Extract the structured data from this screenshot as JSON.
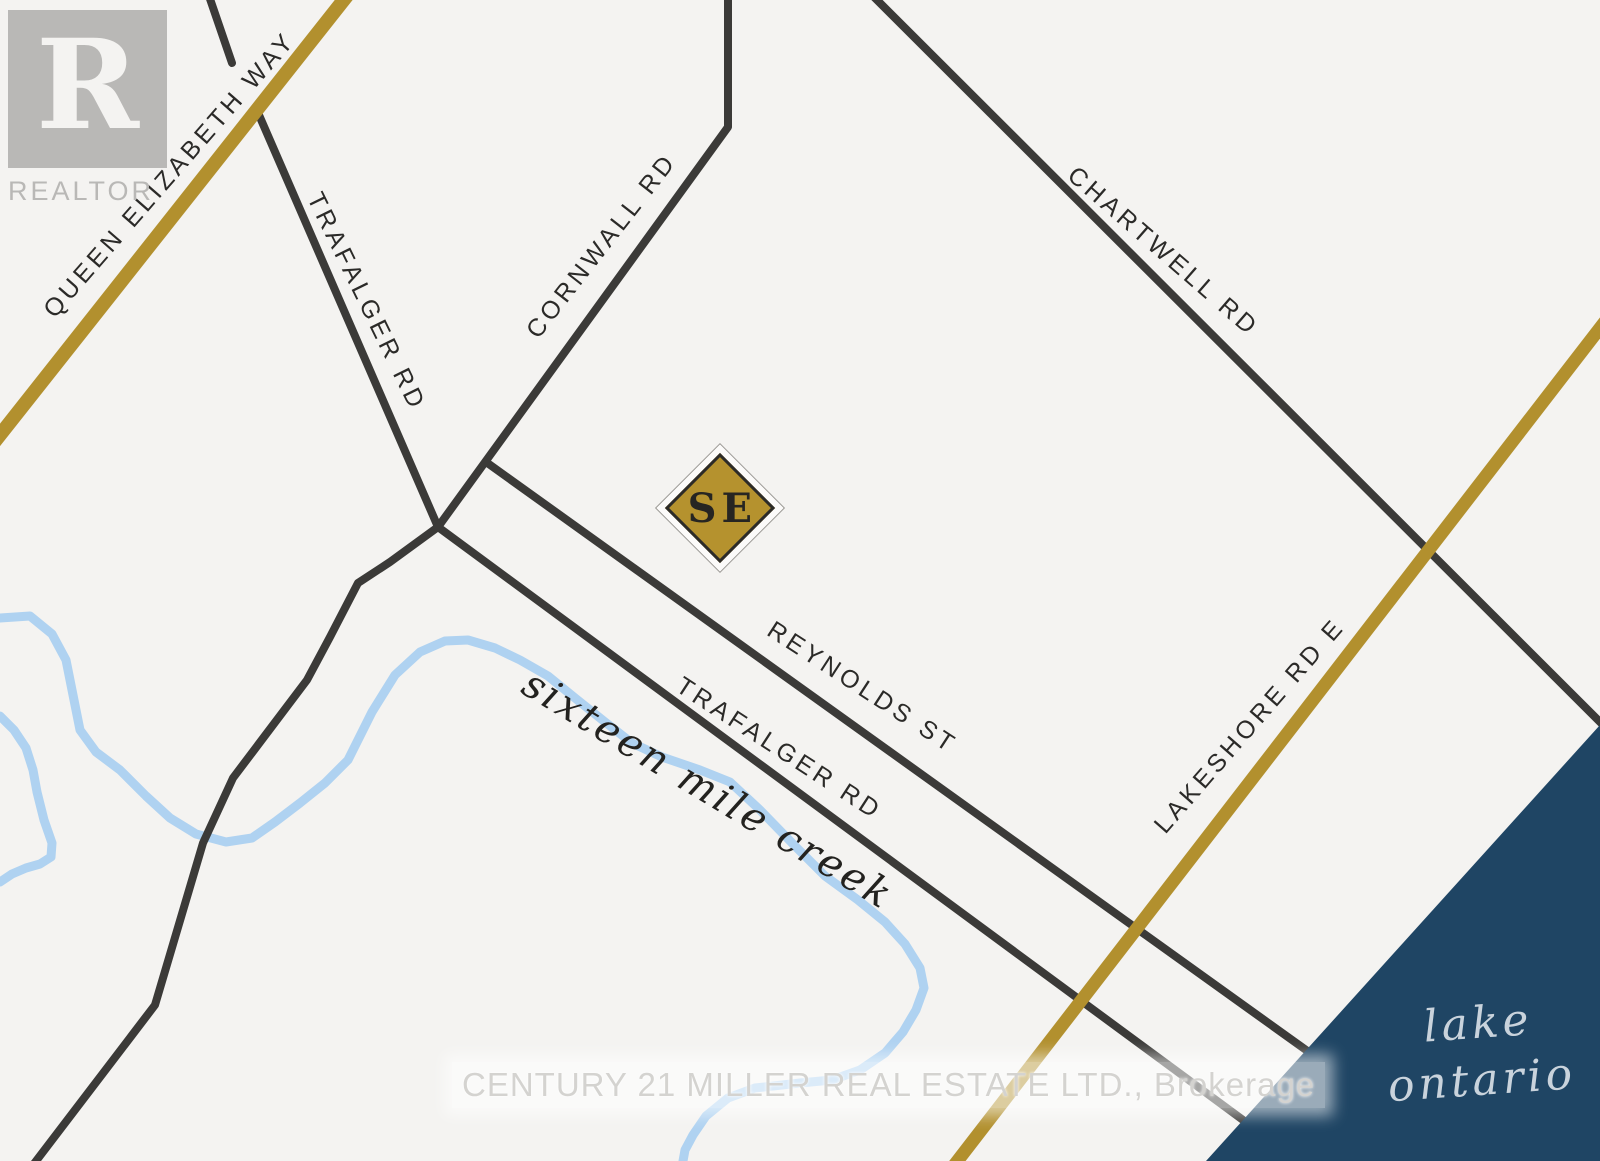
{
  "map": {
    "colors": {
      "background": "#f4f3f1",
      "road": "#3b3a38",
      "highway": "#b2902e",
      "creek": "#afd2f1",
      "lake": "#1f4564",
      "marker_fill": "#b5922e"
    },
    "road_labels": {
      "qew": "QUEEN ELIZABETH WAY",
      "trafalger_north": "TRAFALGER RD",
      "cornwall": "CORNWALL RD",
      "chartwell": "CHARTWELL RD",
      "reynolds": "REYNOLDS ST",
      "trafalger_south": "TRAFALGER RD",
      "lakeshore": "LAKESHORE RD E"
    },
    "water_labels": {
      "creek": "sixteen mile creek",
      "lake_line1": "lake",
      "lake_line2": "ontario"
    },
    "marker": {
      "text": "SE"
    }
  },
  "branding": {
    "logo_letter": "R",
    "logo_word": "REALTOR",
    "watermark": "CENTURY 21 MILLER REAL ESTATE LTD., Brokerage"
  }
}
